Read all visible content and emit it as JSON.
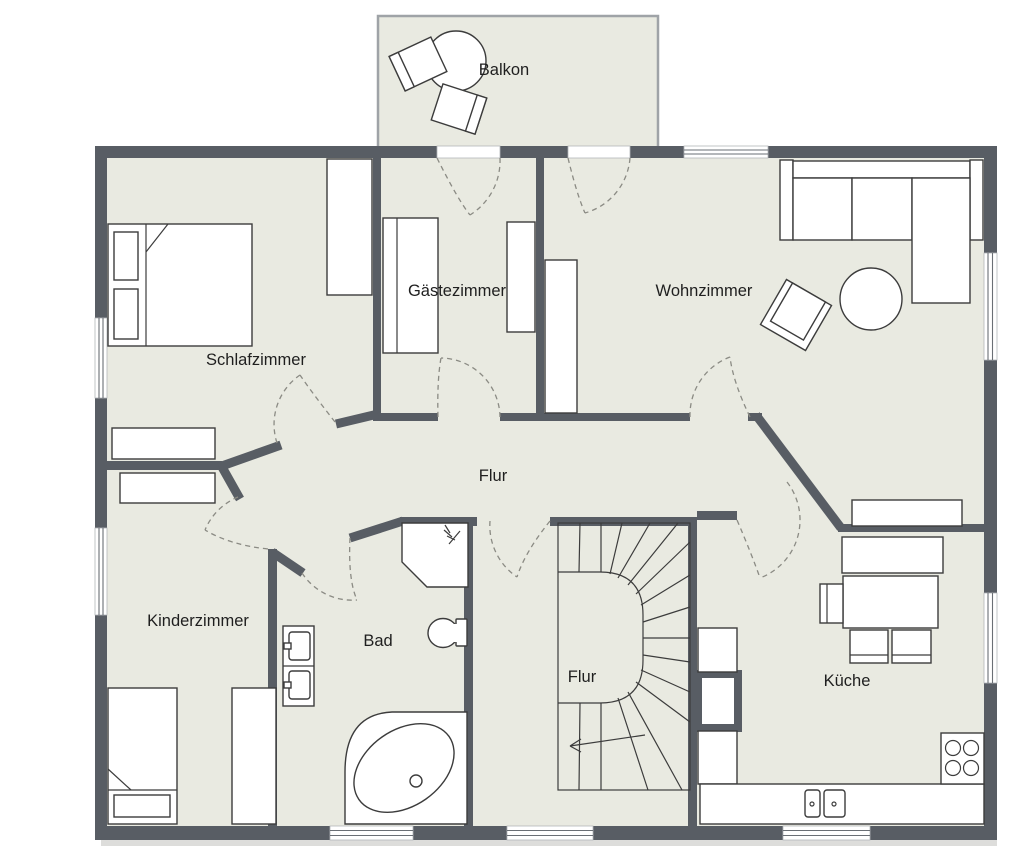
{
  "plan": {
    "title": "Floor plan (upper storey)",
    "rooms": [
      {
        "id": "balkon",
        "label": "Balkon"
      },
      {
        "id": "schlafzimmer",
        "label": "Schlafzimmer"
      },
      {
        "id": "gaestezimmer",
        "label": "Gästezimmer"
      },
      {
        "id": "wohnzimmer",
        "label": "Wohnzimmer"
      },
      {
        "id": "flur-oben",
        "label": "Flur"
      },
      {
        "id": "kinderzimmer",
        "label": "Kinderzimmer"
      },
      {
        "id": "bad",
        "label": "Bad"
      },
      {
        "id": "flur-unten",
        "label": "Flur"
      },
      {
        "id": "kueche",
        "label": "Küche"
      }
    ],
    "icons": {
      "shower": "shower-spray-icon",
      "stairs_direction": "arrow-left (stairs down)"
    },
    "colors": {
      "wall": "#585d64",
      "floor": "#e9eae1",
      "background": "#ffffff",
      "furniture_outline": "#3c3c3c",
      "door_arc": "#8b8b84",
      "window_line": "#6a6f75",
      "label": "#1f1f1f"
    }
  }
}
